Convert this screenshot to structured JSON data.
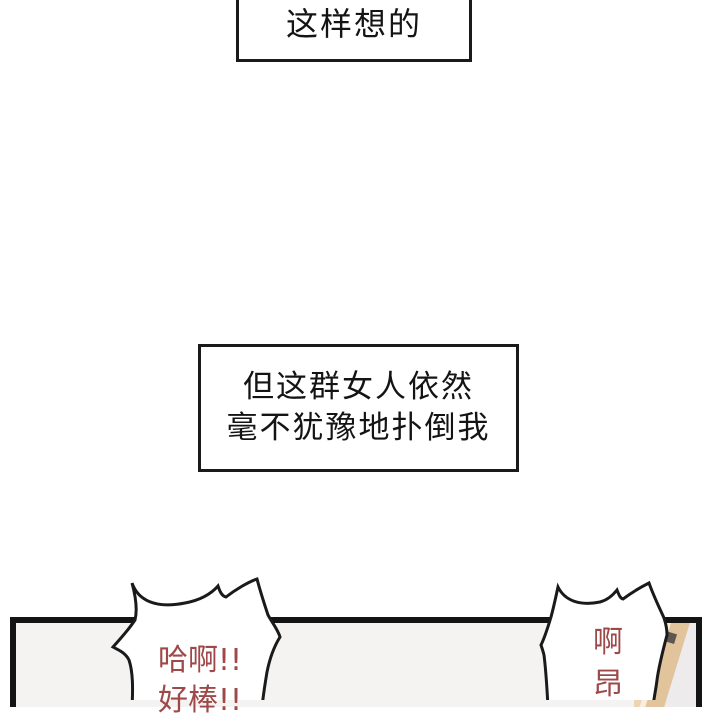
{
  "comic": {
    "caption_top": {
      "text": "这样想的"
    },
    "caption_middle": {
      "lines": [
        "但这群女人依然",
        "毫不犹豫地扑倒我"
      ]
    },
    "bubble_left": {
      "lines": [
        "哈啊!!",
        "好棒!!"
      ]
    },
    "bubble_right": {
      "lines": [
        "啊",
        "昂"
      ]
    },
    "colors": {
      "page_background": "#ffffff",
      "caption_border": "#1a1a1a",
      "caption_text": "#141414",
      "panel_border": "#141414",
      "panel_interior": "#f4f3f1",
      "bubble_fill": "#ffffff",
      "bubble_outline": "#1a1a1a",
      "bubble_text": "#9e4949",
      "artwork_gray_band": "#d9d5d8",
      "artwork_tan_band": "#eed3b4",
      "artwork_cream_band": "#f7eedd",
      "artwork_dark_tan_band": "#e1c39c",
      "artwork_dark_bar": "#5e5751"
    }
  }
}
